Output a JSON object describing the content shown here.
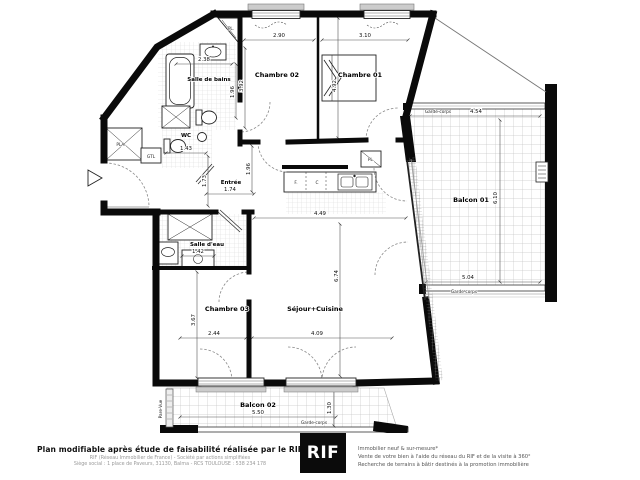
{
  "plan": {
    "rooms": {
      "salle_de_bains": "Salle de bains",
      "wc": "WC",
      "chambre02": "Chambre 02",
      "chambre01": "Chambre 01",
      "entree": "Entrée",
      "salle_deau": "Salle d'eau",
      "chambre03": "Chambre 03",
      "sejour": "Séjour+Cuisine",
      "balcon01": "Balcon 01",
      "balcon02": "Balcon 02"
    },
    "dims": {
      "d290": "2.90",
      "d310": "3.10",
      "d238": "2.38",
      "d392": "3.92",
      "d196a": "1.96",
      "d196b": "1.96",
      "d492": "4.92",
      "d174": "1.74",
      "d143": "1.43",
      "d173": "1.73",
      "d449": "4.49",
      "d674": "6.74",
      "d142": "1.42",
      "d367": "3.67",
      "d244": "2.44",
      "d409": "4.09",
      "d454": "4.54",
      "d610": "6.10",
      "d504": "5.04",
      "d550": "5.50",
      "d130": "1.30"
    },
    "annotations": {
      "garde_corps": "Garde-corps",
      "pare_vue": "Pare-Vue",
      "pla": "PLA.",
      "gtl": "GTL",
      "pl": "PL.",
      "f": "F.",
      "c": "C"
    }
  },
  "footer": {
    "left": {
      "title": "Plan modifiable après étude de faisabilité réalisée par le RIF",
      "line1": "RIF (Réseau Immobilier de France) - Société par actions simplifiées",
      "line2": "Siège social : 1 place de Paveurs, 31130, Balma - RCS TOULOUSE : 538 234 178"
    },
    "logo": "RIF",
    "right": {
      "line1": "Immobilier neuf & sur-mesure*",
      "line2": "Vente de votre bien à l'aide du réseau du RIF et de la visite à 360°",
      "line3": "Recherche de terrains à bâtir destinés à la promotion immobilière"
    }
  },
  "colors": {
    "wall": "#0a0a0a",
    "logo_bg": "#0b0b0b"
  }
}
